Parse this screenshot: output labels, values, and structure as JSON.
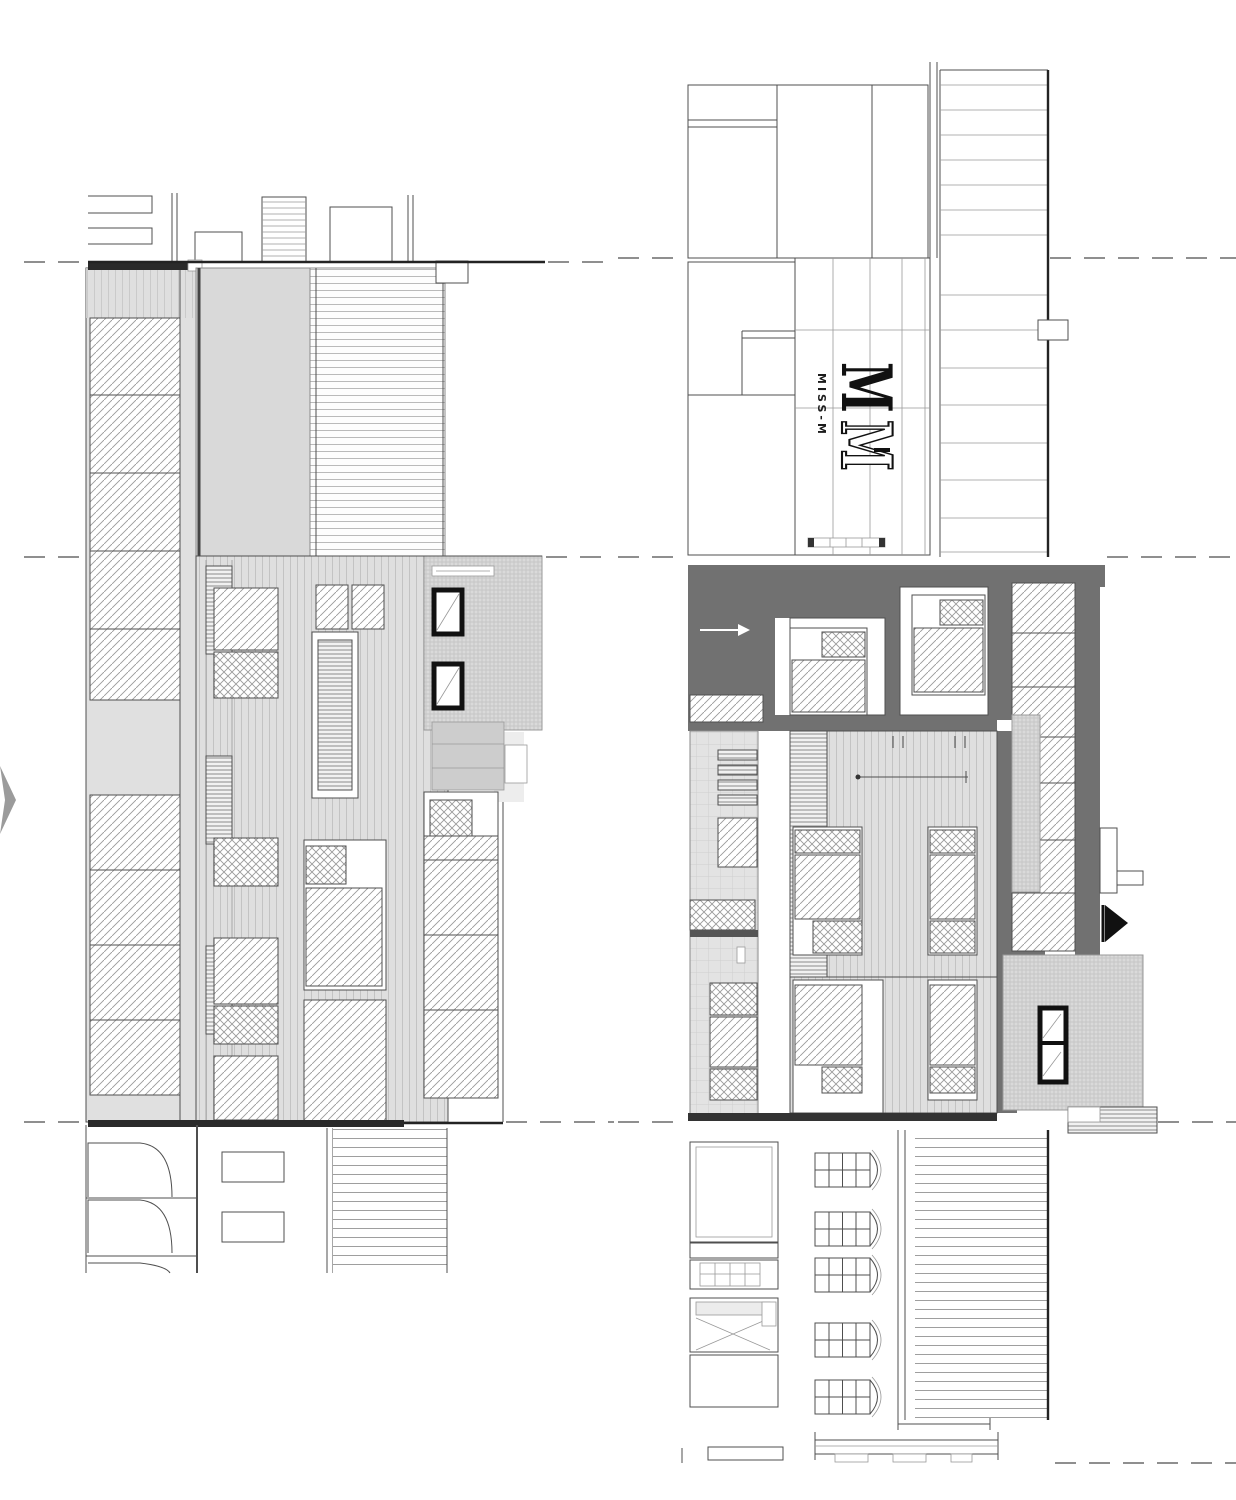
{
  "drawing": {
    "kind": "architectural roof and floor plans, two adjacent buildings",
    "sheets": {
      "left_plan": "roof plan with skylights, decking and annex",
      "right_plan": "roof terrace floor plan with bedrooms, annex and arched windows"
    }
  },
  "logo": {
    "monogram_top": "M",
    "monogram_bottom": "M",
    "label": "MISS-M"
  },
  "colors": {
    "bg": "#ffffff",
    "line": "#4f4f4f",
    "line-dark": "#232323",
    "fill-light": "#e0e0e0",
    "fill-terrace": "#d9d9d9",
    "fill-medium": "#cdcdcd",
    "poche": "#717171",
    "frame": "#111111",
    "arrow": "#9b9b9b",
    "grid": "#6a6a6a"
  }
}
